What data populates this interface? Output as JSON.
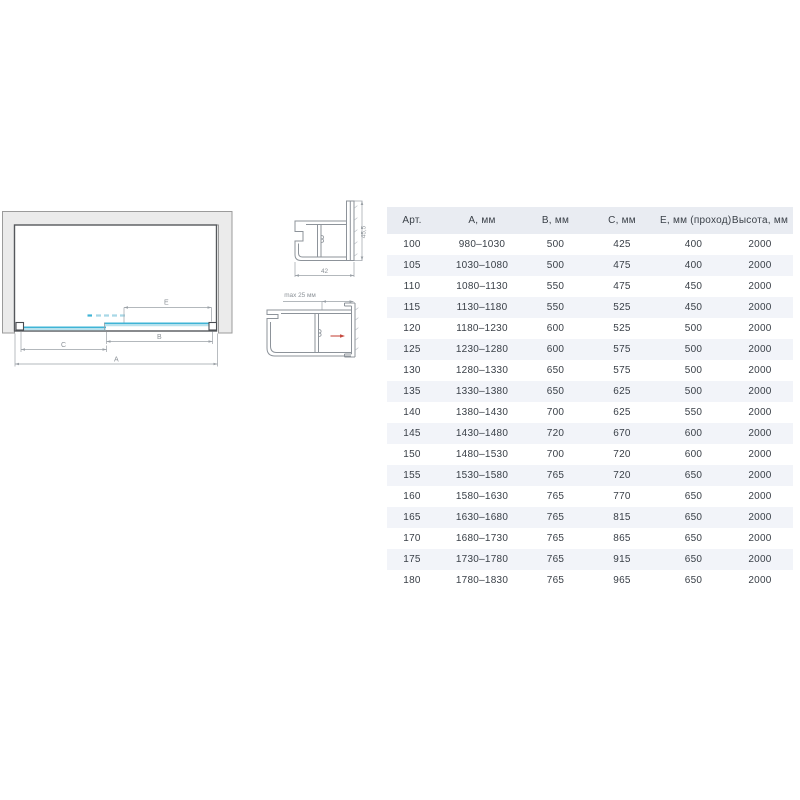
{
  "diagram": {
    "dim_labels": {
      "a": "А",
      "b": "В",
      "c": "С",
      "e": "Е"
    },
    "colors": {
      "wall_fill": "#ebebeb",
      "wall_stroke": "#9b9b9b",
      "frame_stroke": "#55585c",
      "glass": "#3fb4d6",
      "glass_light": "#b9e2ee",
      "dimension": "#9aa0a6",
      "dimension_text": "#8b9197"
    }
  },
  "profiles": {
    "wall_profile": {
      "width_mm": "42",
      "height_mm": "45,5"
    },
    "adjustment": {
      "label": "max 25 мм",
      "arrow_color": "#c64a3f"
    }
  },
  "table": {
    "header_bg": "#e9ecf2",
    "alt_row_bg": "#f2f4f9",
    "text_color": "#3a4048",
    "headers": [
      "Арт.",
      "А, мм",
      "В, мм",
      "С, мм",
      "Е, мм (проход)",
      "Высота, мм"
    ],
    "rows": [
      [
        "100",
        "980–1030",
        "500",
        "425",
        "400",
        "2000"
      ],
      [
        "105",
        "1030–1080",
        "500",
        "475",
        "400",
        "2000"
      ],
      [
        "110",
        "1080–1130",
        "550",
        "475",
        "450",
        "2000"
      ],
      [
        "115",
        "1130–1180",
        "550",
        "525",
        "450",
        "2000"
      ],
      [
        "120",
        "1180–1230",
        "600",
        "525",
        "500",
        "2000"
      ],
      [
        "125",
        "1230–1280",
        "600",
        "575",
        "500",
        "2000"
      ],
      [
        "130",
        "1280–1330",
        "650",
        "575",
        "500",
        "2000"
      ],
      [
        "135",
        "1330–1380",
        "650",
        "625",
        "500",
        "2000"
      ],
      [
        "140",
        "1380–1430",
        "700",
        "625",
        "550",
        "2000"
      ],
      [
        "145",
        "1430–1480",
        "720",
        "670",
        "600",
        "2000"
      ],
      [
        "150",
        "1480–1530",
        "700",
        "720",
        "600",
        "2000"
      ],
      [
        "155",
        "1530–1580",
        "765",
        "720",
        "650",
        "2000"
      ],
      [
        "160",
        "1580–1630",
        "765",
        "770",
        "650",
        "2000"
      ],
      [
        "165",
        "1630–1680",
        "765",
        "815",
        "650",
        "2000"
      ],
      [
        "170",
        "1680–1730",
        "765",
        "865",
        "650",
        "2000"
      ],
      [
        "175",
        "1730–1780",
        "765",
        "915",
        "650",
        "2000"
      ],
      [
        "180",
        "1780–1830",
        "765",
        "965",
        "650",
        "2000"
      ]
    ]
  }
}
